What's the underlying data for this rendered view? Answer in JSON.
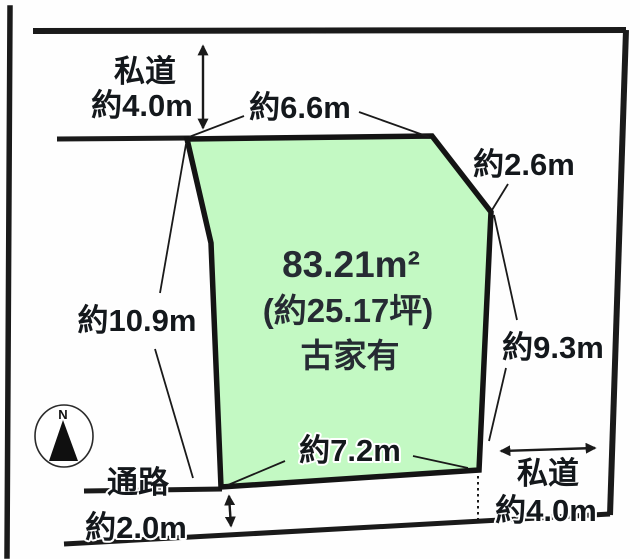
{
  "plot": {
    "area": "83.21m²",
    "area_tsubo": "(約25.17坪)",
    "building_note": "古家有"
  },
  "dimensions": {
    "top_road": {
      "label": "私道",
      "width": "約4.0m"
    },
    "top_edge": "約6.6m",
    "top_right_edge": "約2.6m",
    "left_edge": "約10.9m",
    "right_edge": "約9.3m",
    "bottom_edge": "約7.2m",
    "passage": {
      "label": "通路",
      "width": "約2.0m"
    },
    "right_road": {
      "label": "私道",
      "width": "約4.0m"
    }
  },
  "compass": {
    "north": "N"
  },
  "colors": {
    "line": "#1a1a1a",
    "plot_fill": "#c3f9c3",
    "plot_border": "#141414",
    "label_text": "#14181c",
    "area_text": "#262b33"
  }
}
